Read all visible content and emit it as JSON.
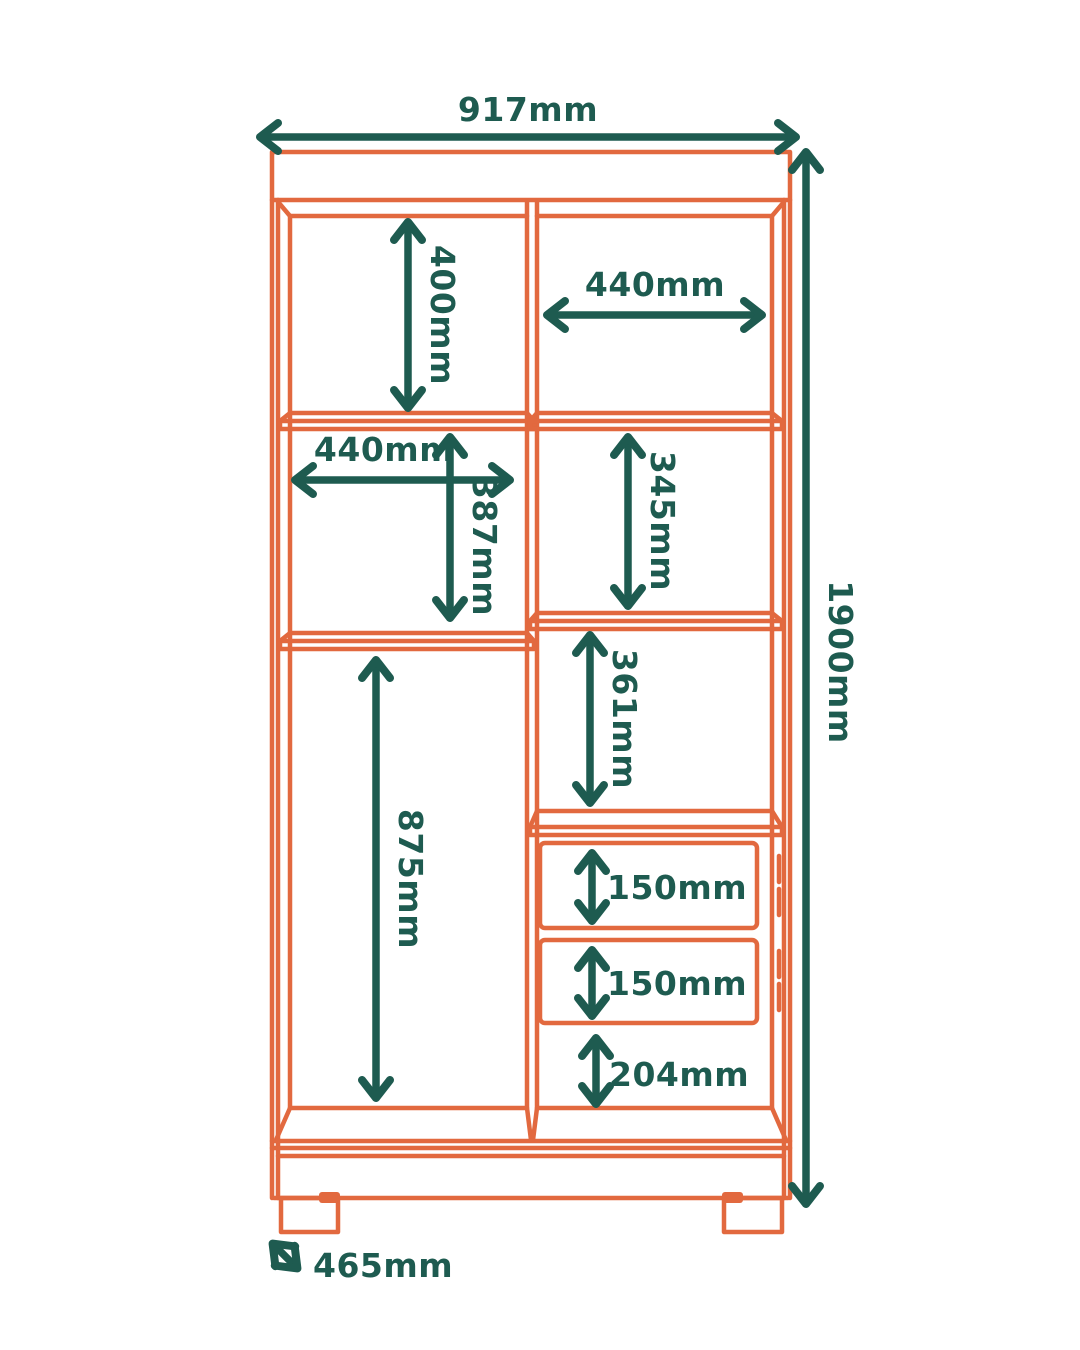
{
  "diagram": {
    "kind": "furniture-dimension-drawing",
    "subject": "wardrobe cabinet front elevation with shelves and drawers",
    "colors": {
      "cabinet_outline": "#E2693F",
      "dimension": "#1E5B50",
      "background": "#FFFFFF"
    },
    "overall": {
      "width": "917mm",
      "height": "1900mm",
      "depth": "465mm"
    },
    "labels": {
      "overall_width": "917mm",
      "overall_height": "1900mm",
      "depth": "465mm",
      "left_upper_height": "400mm",
      "right_upper_width": "440mm",
      "left_middle_width": "440mm",
      "left_middle_height": "387mm",
      "right_second_height": "345mm",
      "right_third_height": "361mm",
      "left_lower_height": "875mm",
      "drawer_top_height": "150mm",
      "drawer_bottom_height": "150mm",
      "right_lower_height": "204mm"
    }
  }
}
